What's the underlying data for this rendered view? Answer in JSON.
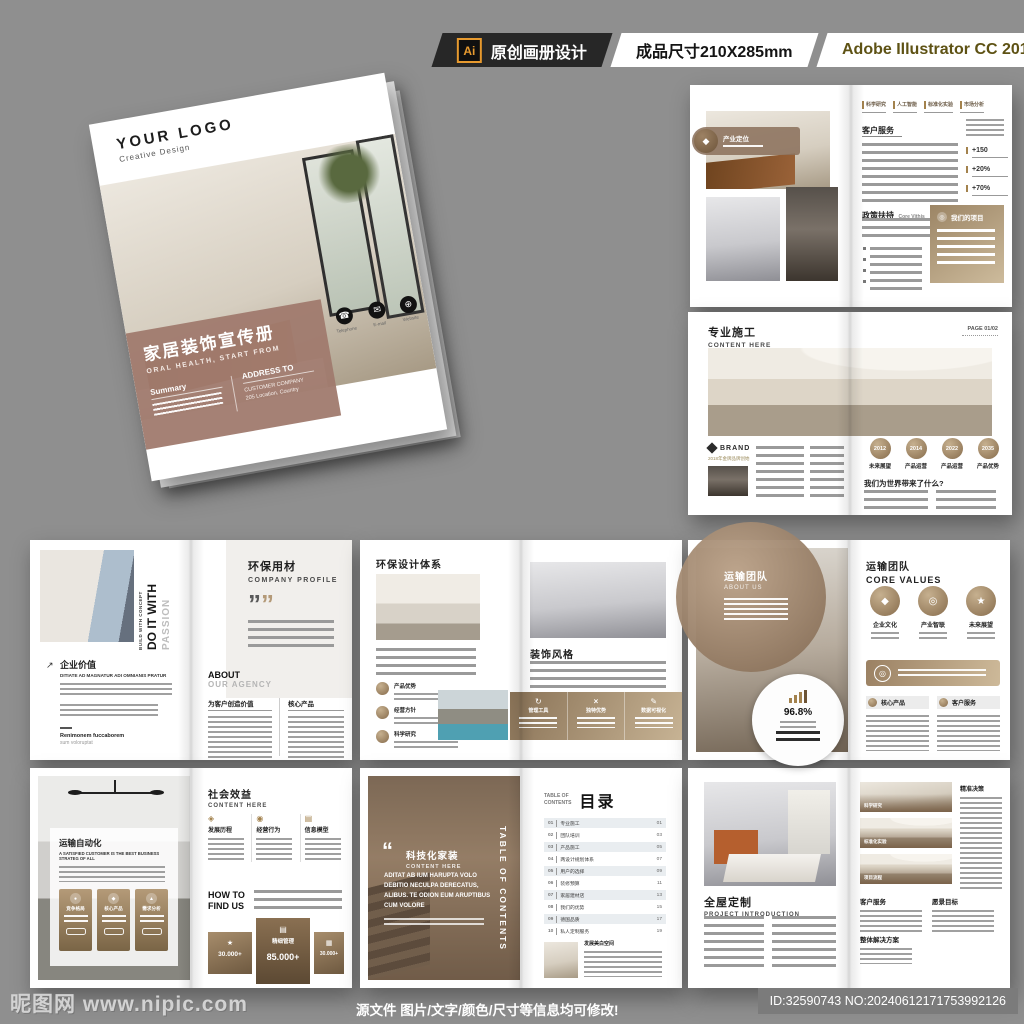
{
  "colors": {
    "background": "#8f8f8f",
    "accent_tan": "#a98c68",
    "accent_gold": "#a3824d",
    "cover_mauve": "#a07a6e",
    "bar_dark": "#272727"
  },
  "top_bar": {
    "ai_badge": "Ai",
    "label_design": "原创画册设计",
    "label_size": "成品尺寸210X285mm",
    "label_software": "Adobe Illustrator CC 2018"
  },
  "footer": {
    "watermark": "昵图网 www.nipic.com",
    "notice": "源文件 图片/文字/颜色/尺寸等信息均可修改!",
    "id_text": "ID:32590743 NO:20240612171753992126"
  },
  "cover": {
    "logo": "YOUR LOGO",
    "logo_sub": "Creative Design",
    "title": "家居装饰宣传册",
    "subtitle": "ORAL HEALTH, START FROM",
    "summary_title": "Summary",
    "address_title": "ADDRESS TO",
    "address_line1": "CUSTOMER COMPANY",
    "address_line2": "205 Location, Country",
    "contacts": [
      "Telephone",
      "E-mail",
      "Website"
    ]
  },
  "spread1": {
    "badge": "产业定位",
    "tabs": [
      "科学研究",
      "人工智能",
      "标准化实验",
      "市场分析"
    ],
    "heading1": "客户服务",
    "stats": [
      "+150",
      "+20%",
      "+70%"
    ],
    "heading2": "政策扶持",
    "heading2_sub": "Core Vithis",
    "box_title": "我们的项目"
  },
  "spread2": {
    "title": "专业施工",
    "subtitle": "CONTENT HERE",
    "page": "PAGE 01/02",
    "brand": "BRAND",
    "brand_sub": "2018年金牌品牌创始",
    "years": [
      "2012",
      "2014",
      "2022",
      "2035"
    ],
    "year_labels": [
      "未来展望",
      "产品运营",
      "产品运营",
      "产品优势"
    ],
    "question": "我们为世界带来了什么?"
  },
  "spread3": {
    "vertical_small": "BUILD WITH CONCEPT",
    "vertical_big": "DO IT WITH",
    "vertical_gray": "PASSION",
    "heading": "企业价值",
    "heading_sub": "DITIATE AD MAGNATUR ADI OMNIANIS PRATUR",
    "footer_name": "Renimonem fuccaborem",
    "footer_sub": "sum voloruptat",
    "right_title": "环保用材",
    "right_sub": "COMPANY PROFILE",
    "about": "ABOUT",
    "about_sub": "OUR AGENCY",
    "col1": "为客户创造价值",
    "col2": "核心产品",
    "quote_mark": "””"
  },
  "spread4": {
    "left_title": "环保设计体系",
    "badges": [
      "产品优势",
      "经营方针",
      "科学研究"
    ],
    "right_title": "装饰风格",
    "band_items": [
      "管理工具",
      "独特优势",
      "数据可视化"
    ]
  },
  "spread5": {
    "left_title": "运输团队",
    "left_sub": "ABOUT US",
    "percent": "96.8%",
    "right_title": "运输团队",
    "right_sub": "CORE VALUES",
    "values": [
      "企业文化",
      "产业智联",
      "未来展望"
    ],
    "sections": [
      "核心产品",
      "客户服务"
    ]
  },
  "spread6": {
    "left_title": "运输自动化",
    "left_sub": "A SATISFIED CUSTOMER IS THE BEST BUSINESS STRATEG OF ALL",
    "cards": [
      "竞争格局",
      "核心产品",
      "需求分析"
    ],
    "right_title": "社会效益",
    "right_sub": "CONTENT HERE",
    "columns": [
      "发展历程",
      "经营行为",
      "信息模型"
    ],
    "howto1": "HOW TO",
    "howto2": "FIND US",
    "stat_left": "30.000+",
    "stat_center_label": "精细管理",
    "stat_center": "85.000+",
    "stat_right": "30.000+"
  },
  "spread7": {
    "quote_mark": "“",
    "quote_title": "科技化家装",
    "quote_sub": "CONTENT HERE",
    "quote_text": "ADITAT AB IUM HARUPTA VOLO DEBITIO NECULPA DERECATUS, ALIBUS. TE ODION EUM ARUPTIBUS CUM VOLORE",
    "vertical": "TABLE OF CONTENTS",
    "toc_label1": "TABLE OF",
    "toc_label2": "CONTENTS",
    "toc_title": "目录",
    "toc_items": [
      {
        "no": "01",
        "label": "专业施工",
        "page": "01"
      },
      {
        "no": "02",
        "label": "团队培训",
        "page": "03"
      },
      {
        "no": "03",
        "label": "产品施工",
        "page": "05"
      },
      {
        "no": "04",
        "label": "两设计规划体系",
        "page": "07"
      },
      {
        "no": "05",
        "label": "用户的选择",
        "page": "09"
      },
      {
        "no": "06",
        "label": "装修预算",
        "page": "11"
      },
      {
        "no": "07",
        "label": "家居建材店",
        "page": "13"
      },
      {
        "no": "08",
        "label": "我们的优势",
        "page": "15"
      },
      {
        "no": "09",
        "label": "德国品质",
        "page": "17"
      },
      {
        "no": "10",
        "label": "私人定制服务",
        "page": "19"
      }
    ],
    "caption_title": "发展美白空间"
  },
  "spread8": {
    "left_title": "全屋定制",
    "left_sub": "PROJECT INTRODUCTION",
    "photo_labels": [
      "科学研究",
      "标准化实验",
      "项目流程"
    ],
    "right_col": "精准决策",
    "sections": [
      "客户服务",
      "愿景目标"
    ],
    "bottom": "整体解决方案"
  }
}
